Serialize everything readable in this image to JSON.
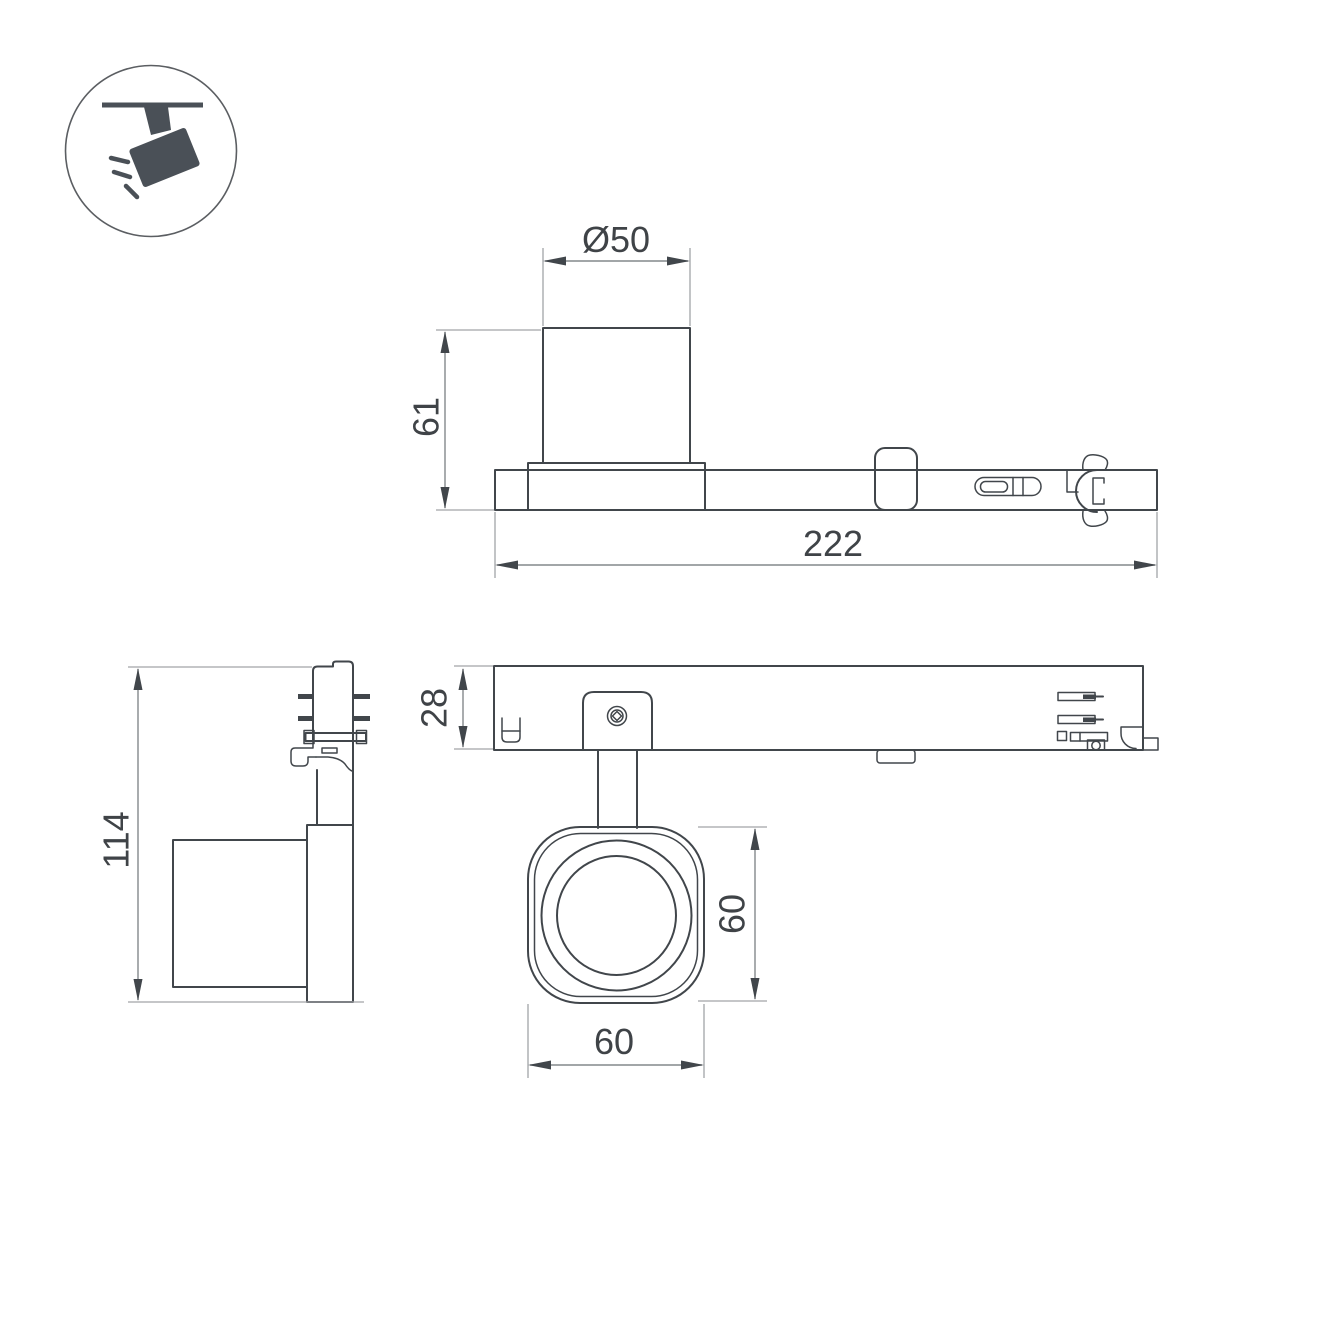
{
  "colors": {
    "line": "#41464b",
    "dim": "#84888c",
    "ext": "#a2a5a8",
    "text": "#3f4347",
    "icon": "#4a5057",
    "background": "#ffffff"
  },
  "icon": {
    "name": "track-spotlight-icon"
  },
  "dims": {
    "side": {
      "diameter": "Ø50",
      "height": "61",
      "length": "222"
    },
    "front": {
      "height": "114"
    },
    "plan": {
      "track": "28",
      "head_height": "60",
      "head_width": "60"
    }
  }
}
